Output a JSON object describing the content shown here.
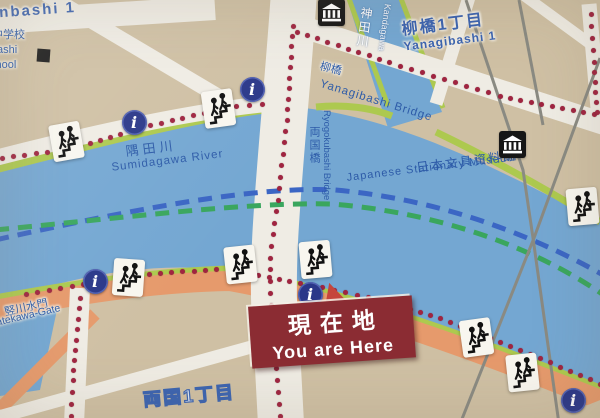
{
  "labels": {
    "street_top": "onbashi 1",
    "school_line1": "中学校",
    "school_line2": "ashi",
    "school_line3": "chool",
    "kandagawa_kanji": "神田川",
    "kandagawa_romaji": "Kandagawa",
    "yanagibashi1_kanji": "柳橋1丁目",
    "yanagibashi1_romaji": "Yanagibashi 1",
    "yanagibashi_bridge_kanji": "柳橋",
    "yanagibashi_bridge_romaji": "Yanagibashi Bridge",
    "sumidagawa_kanji": "隅田川",
    "sumidagawa_romaji": "Sumidagawa River",
    "ryogokubashi_kanji": "両国橋",
    "ryogokubashi_romaji": "Ryogokubashi Bridge",
    "museum_kanji": "日本文具資料館",
    "museum_romaji": "Japanese Stationary Museum",
    "tatekawa_kanji": "竪川水門",
    "tatekawa_romaji": "Tatekawa-Gate",
    "ryogoku1_kanji": "両国1丁目",
    "you_are_here_kanji": "現在地",
    "you_are_here_en": "You are Here"
  },
  "icons": {
    "info_glyph": "i",
    "info_meaning": "information-point",
    "stairs_meaning": "riverside-stairs-access",
    "building_meaning": "museum-building",
    "school_meaning": "school-building"
  },
  "colors": {
    "land": "#cfc0a4",
    "river": "#74a7d2",
    "road": "#efece4",
    "riverside_walk": "#adc94f",
    "main_road": "#e69a6c",
    "route_dot": "#a02440",
    "info_bg": "#2a3789",
    "sign_bg": "#8b2c33",
    "boat_route_blue": "#3b66c4",
    "boat_route_green": "#3aa65e",
    "label_blue": "#2d5ba8",
    "gray_line": "#8a8a82"
  }
}
